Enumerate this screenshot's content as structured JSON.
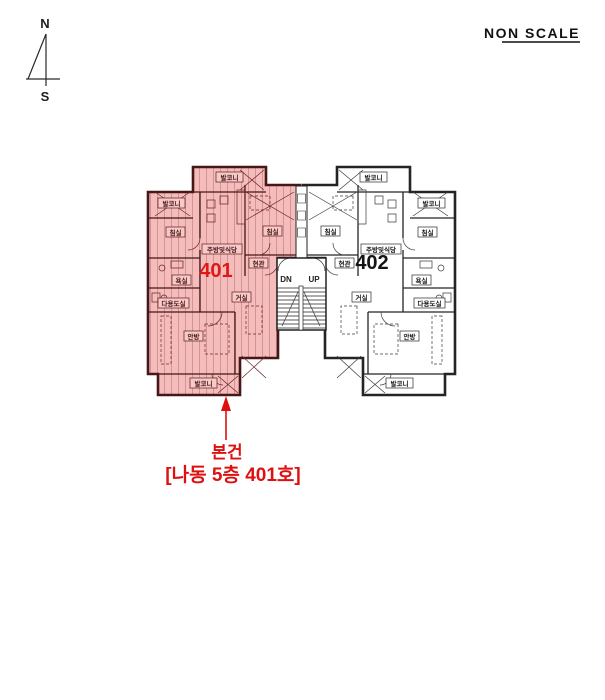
{
  "header": {
    "scale_note": "NON SCALE"
  },
  "compass": {
    "north": "N",
    "south": "S"
  },
  "colors": {
    "highlight_fill": "#f5bcbc",
    "highlight_hatch": "#d08f8f",
    "highlight_wall": "#451717",
    "plain_wall": "#242424",
    "accent_red": "#dd1111",
    "unit401_number_color": "#e01818",
    "unit402_number_color": "#151515"
  },
  "plan": {
    "stairs": {
      "down": "DN",
      "up": "UP"
    },
    "unit401": {
      "number": "401",
      "labels": {
        "balcony_top": "발코니",
        "balcony_side": "발코니",
        "bedroom_left": "침실",
        "bedroom_right": "침실",
        "kitchen_dining": "주방및식당",
        "entrance": "현관",
        "bathroom": "욕실",
        "utility": "다용도실",
        "living_room": "거실",
        "master_bedroom": "안방",
        "balcony_bottom": "발코니"
      }
    },
    "unit402": {
      "number": "402",
      "labels": {
        "balcony_top": "발코니",
        "balcony_side": "발코니",
        "bedroom_left": "침실",
        "bedroom_right": "침실",
        "kitchen_dining": "주방및식당",
        "entrance": "현관",
        "bathroom": "욕실",
        "utility": "다용도실",
        "living_room": "거실",
        "master_bedroom": "안방",
        "balcony_bottom": "발코니"
      }
    }
  },
  "callout": {
    "line1": "본건",
    "line2": "[나동 5층 401호]"
  }
}
